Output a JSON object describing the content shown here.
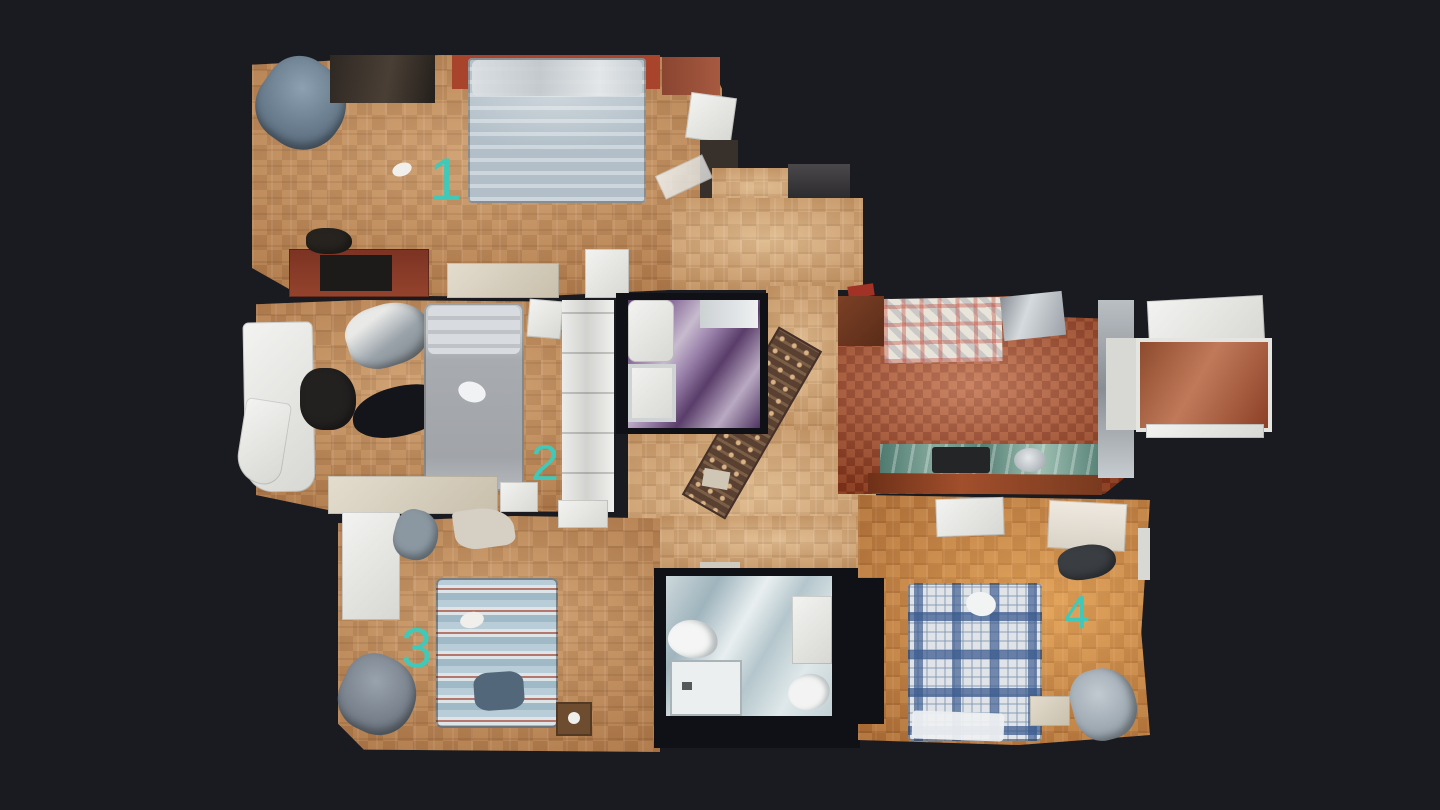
{
  "view": {
    "type": "3d-scan-floorplan-top-view",
    "background_color": "#1a1b20"
  },
  "floorplan": {
    "label_color": "#40c9b8",
    "room_labels": [
      {
        "id": "bedroom-1",
        "label": "1"
      },
      {
        "id": "bedroom-2",
        "label": "2"
      },
      {
        "id": "bedroom-3",
        "label": "3"
      },
      {
        "id": "bedroom-4",
        "label": "4"
      }
    ],
    "areas": [
      {
        "id": "bedroom-1"
      },
      {
        "id": "bedroom-2"
      },
      {
        "id": "bedroom-3"
      },
      {
        "id": "bedroom-4"
      },
      {
        "id": "kitchen"
      },
      {
        "id": "bathroom-1"
      },
      {
        "id": "bathroom-2"
      },
      {
        "id": "entry-hall"
      },
      {
        "id": "central-hall"
      },
      {
        "id": "balcony"
      }
    ],
    "palette": {
      "parquet_floor": "#c28a56",
      "kitchen_tile": "#a14c2b",
      "kitchen_counter_marble": "#5d8a7d",
      "bathroom1_floor_purple": "#7a5a8c",
      "bathroom2_floor_blue": "#c6d4d9",
      "accent_label_teal": "#40c9b8"
    }
  }
}
